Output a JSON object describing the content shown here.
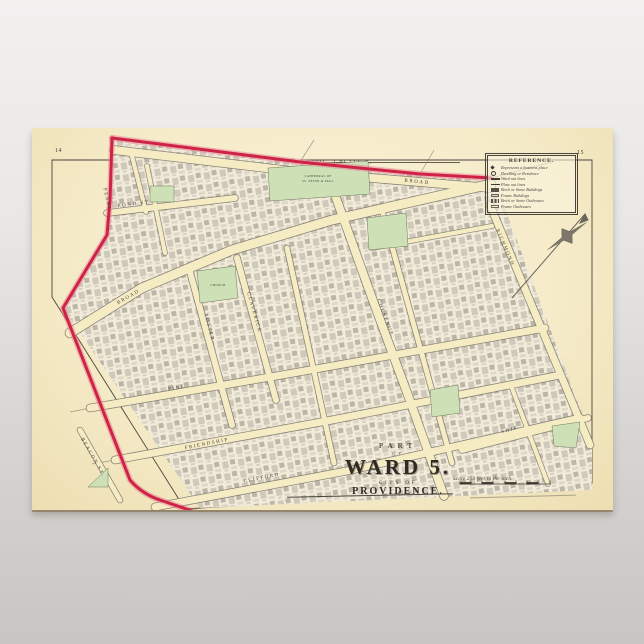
{
  "plate": {
    "volume_label": "VOL. 2-PLATE B.",
    "page_number_left": "14",
    "page_number_right": "15"
  },
  "title_block": {
    "part": "PART",
    "of": "OF",
    "ward": "WARD 5.",
    "city_of": "CITY OF",
    "city": "PROVIDENCE."
  },
  "scale": {
    "text": "Scale 200 feet to the inch."
  },
  "reference": {
    "title": "REFERENCE.",
    "items": [
      {
        "symbol": "business-mark",
        "label": "Represents a business place"
      },
      {
        "symbol": "dwelling-mark",
        "label": "Dwelling or Residence"
      },
      {
        "symbol": "ward-line",
        "label": "Ward out lines"
      },
      {
        "symbol": "plate-line",
        "label": "Plate out lines"
      },
      {
        "symbol": "brick-building",
        "label": "Brick or Stone Buildings"
      },
      {
        "symbol": "frame-building",
        "label": "Frame Buildings"
      },
      {
        "symbol": "brick-outhouse",
        "label": "Brick or Stone Outhouses"
      },
      {
        "symbol": "frame-outhouse",
        "label": "Frame Outhouses"
      }
    ]
  },
  "streets": {
    "pearl": "PEARL",
    "pond": "POND ST.",
    "broad": "BROAD",
    "foster": "FOSTER",
    "claverick": "CLAVERICK",
    "chestnut": "CHESTNUT",
    "richmond": "RICHMOND",
    "pine": "PINE",
    "friendship": "FRIENDSHIP",
    "clifford": "CLIFFORD",
    "ship": "SHIP",
    "beacon": "BEACON ST."
  },
  "landmarks": {
    "cathedral_line1": "CATHEDRAL OF",
    "cathedral_line2": "SS. PETER & PAUL",
    "church": "CHURCH"
  },
  "colors": {
    "boundary_red": "#cf2346",
    "boundary_glow": "#e87f95",
    "park_green": "#cde0b6",
    "paper_cream": "#f6ecca",
    "street_cream": "#f6ecc4",
    "building_gray": "#a9a49a",
    "ink": "#4a443c"
  }
}
